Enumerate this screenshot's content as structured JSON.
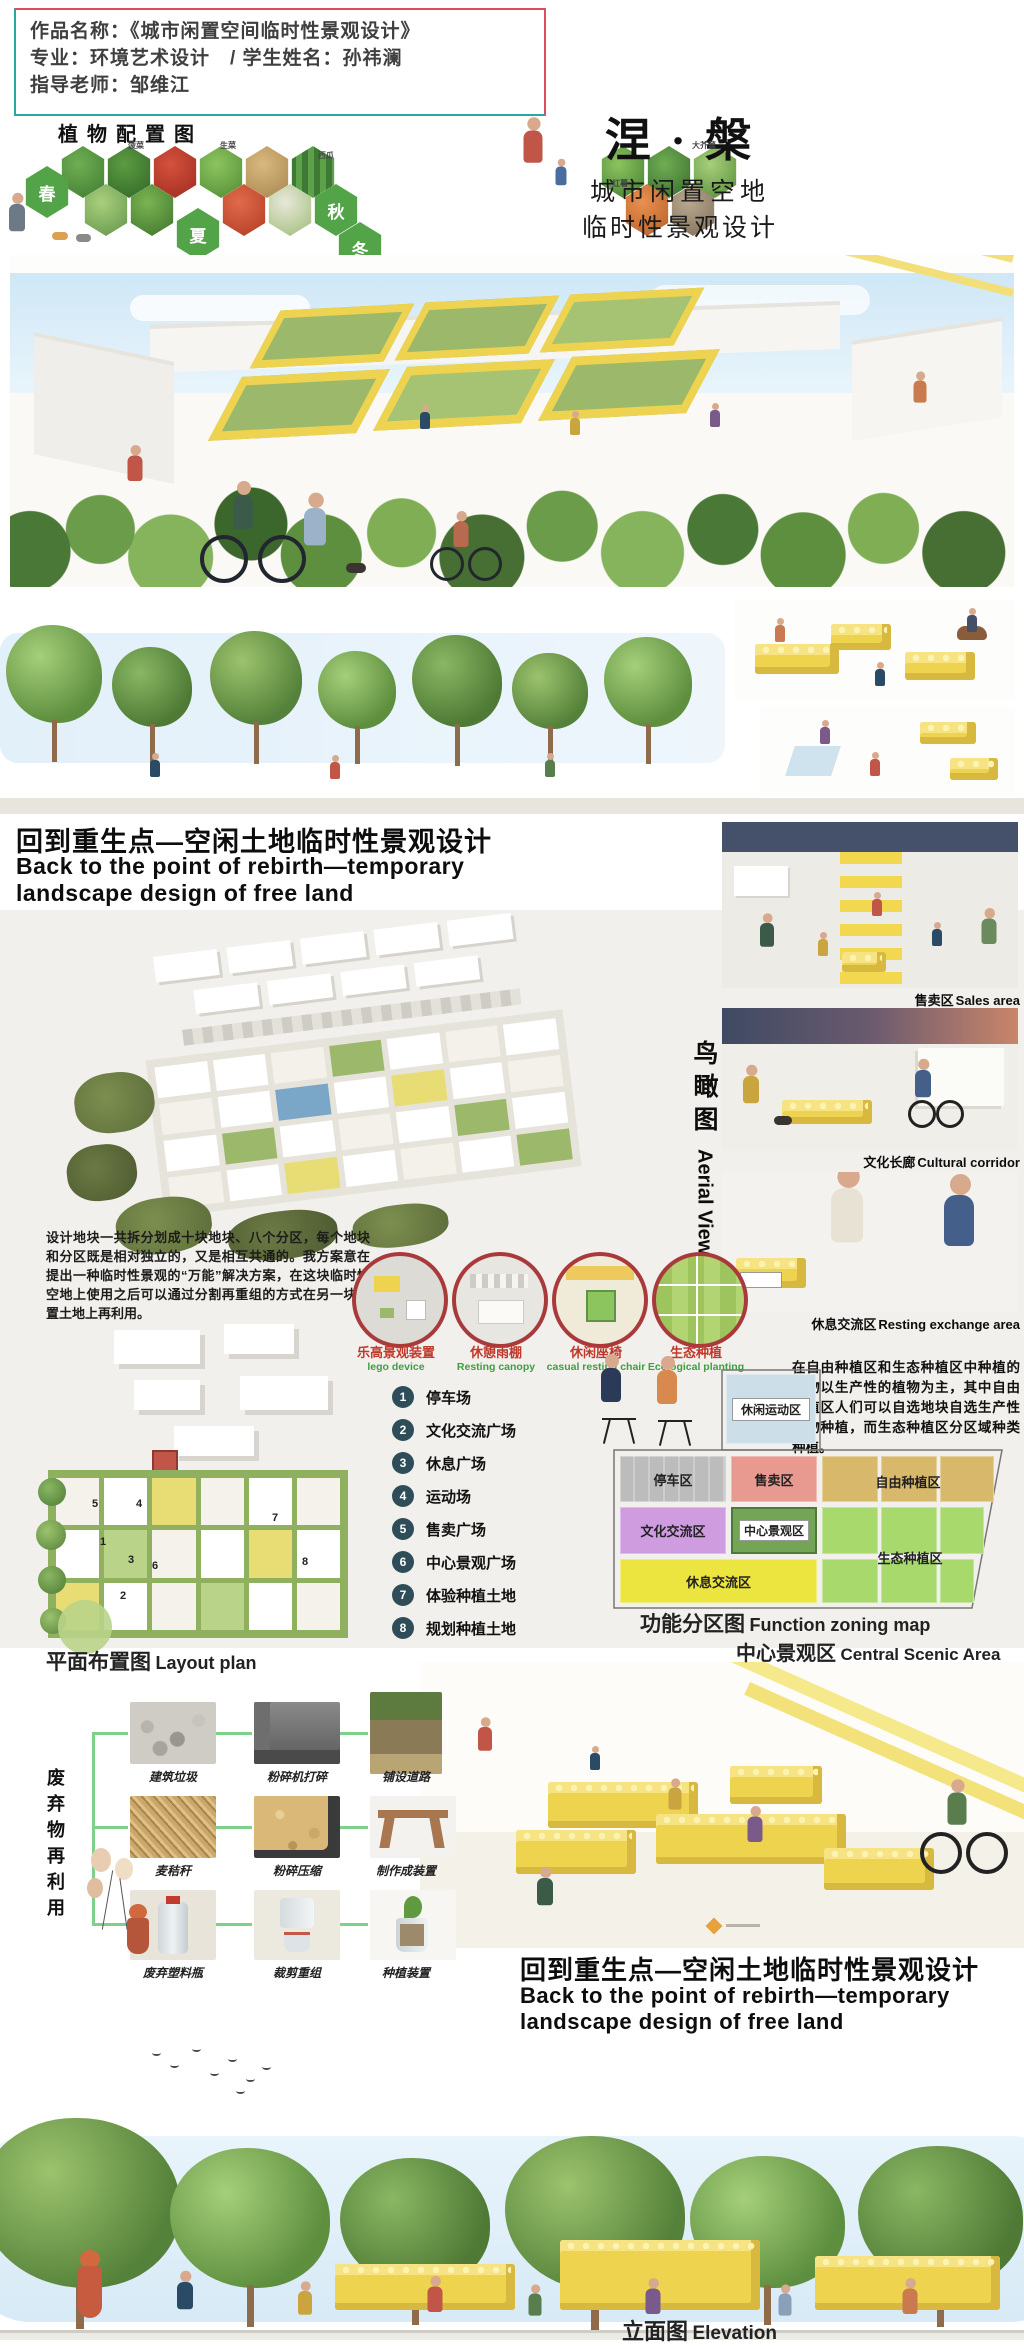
{
  "title_box": {
    "line1": "作品名称：《城市闲置空间临时性景观设计》",
    "line2": "专业：环境艺术设计　/ 学生姓名：孙祎澜",
    "line3": "指导老师：邹维江"
  },
  "plant_config": {
    "title": "植物配置图",
    "seasons": [
      "春",
      "夏",
      "秋",
      "冬"
    ],
    "labels": [
      "菠菜",
      "生菜",
      "西瓜",
      "大芥菜",
      "红薯"
    ]
  },
  "main_title": {
    "title": "涅 · 槃",
    "subtitle1": "城市闲置空地",
    "subtitle2": "临时性景观设计"
  },
  "section_heading": {
    "zh": "回到重生点—空闲土地临时性景观设计",
    "en1": "Back to the point of rebirth—temporary",
    "en2": "landscape design of free land"
  },
  "aerial": {
    "zh": "鸟瞰图",
    "en": "Aerial View"
  },
  "gallery": [
    {
      "zh": "售卖区",
      "en": "Sales area"
    },
    {
      "zh": "文化长廊",
      "en": "Cultural corridor"
    },
    {
      "zh": "休息交流区",
      "en": "Resting exchange area"
    }
  ],
  "intro_paragraph": "设计地块一共拆分划成十块地块、八个分区，每个地块和分区既是相对独立的，又是相互共通的。我方案意在提出一种临时性景观的“万能”解决方案，在这块临时性空地上使用之后可以通过分割再重组的方式在另一块闲置土地上再利用。",
  "features": [
    {
      "zh": "乐高景观装置",
      "en": "lego device"
    },
    {
      "zh": "休憩雨棚",
      "en": "Resting canopy"
    },
    {
      "zh": "休闲座椅",
      "en": "casual resting chair"
    },
    {
      "zh": "生态种植",
      "en": "Ecological planting"
    }
  ],
  "legend": {
    "items": [
      {
        "n": "1",
        "label": "停车场"
      },
      {
        "n": "2",
        "label": "文化交流广场"
      },
      {
        "n": "3",
        "label": "休息广场"
      },
      {
        "n": "4",
        "label": "运动场"
      },
      {
        "n": "5",
        "label": "售卖广场"
      },
      {
        "n": "6",
        "label": "中心景观广场"
      },
      {
        "n": "7",
        "label": "体验种植土地"
      },
      {
        "n": "8",
        "label": "规划种植土地"
      }
    ]
  },
  "plan": {
    "zh": "平面布置图",
    "en": "Layout plan",
    "markers": [
      "1",
      "2",
      "3",
      "4",
      "5",
      "6",
      "7",
      "8"
    ]
  },
  "zoning": {
    "paragraph": "在自由种植区和生态种植区中种植的植物以生产性的植物为主，其中自由种植区人们可以自选地块自选生产性植物种植，而生态种植区分区域种类种植。",
    "title_zh": "功能分区图",
    "title_en": "Function zoning map",
    "cells": {
      "leisure": "休闲运动区",
      "parking": "停车区",
      "sales": "售卖区",
      "free_planting": "自由种植区",
      "culture": "文化交流区",
      "central": "中心景观区",
      "rest": "休息交流区",
      "eco": "生态种植区"
    }
  },
  "central_area": {
    "zh": "中心景观区",
    "en": "Central Scenic Area"
  },
  "waste": {
    "vertical": "废弃物再利用",
    "steps": [
      {
        "a": "建筑垃圾",
        "b": "粉碎机打碎",
        "c": "铺设道路"
      },
      {
        "a": "麦秸秆",
        "b": "粉碎压缩",
        "c": "制作成装置"
      },
      {
        "a": "废弃塑料瓶",
        "b": "裁剪重组",
        "c": "种植装置"
      }
    ]
  },
  "elevation": {
    "zh": "立面图",
    "en": "Elevation"
  },
  "colors": {
    "box_border_teal": "#2aa7a0",
    "box_border_red": "#d94f5c",
    "lego_yellow": "#eed34e",
    "ring_red": "#a93a3c",
    "legend_marker": "#2e4d59",
    "zone_leisure": "#ccdfe8",
    "zone_parking": "#c6c6c6",
    "zone_sales": "#e89a90",
    "zone_free": "#d8b96b",
    "zone_culture": "#cf9ce0",
    "zone_central": "#74a455",
    "zone_rest": "#ece43f",
    "zone_eco": "#a8d96c",
    "sky_blue": "#d9ecf7",
    "label_red": "#c0392b",
    "label_green": "#3f9d44"
  }
}
